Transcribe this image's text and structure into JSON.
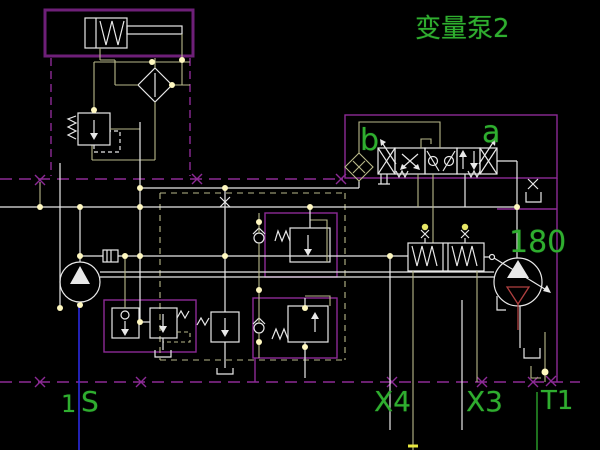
{
  "title": "变量泵2",
  "labels": {
    "pump_title": "变量泵2",
    "valve_solenoid_b": "b",
    "valve_solenoid_a": "a",
    "pump_displacement": "180",
    "port_1": "1",
    "port_s": "S",
    "port_x4": "X4",
    "port_x3": "X3",
    "port_t1": "T1"
  },
  "colors": {
    "background": "#000000",
    "frame_magenta": "#8d2a96",
    "line_white": "#e8e8e8",
    "line_yellow": "#b9b98a",
    "text_green": "#2fae2f",
    "suction_blue": "#2a2ae0",
    "drain_red": "#b04040",
    "node_dot": "#fff8c0"
  },
  "symbols": {
    "top_left": "pilot-piston-symbol",
    "filter": "filter-diamond-symbol",
    "relief": "pressure-relief-valve-symbol",
    "charge_pump": "charge-pump-symbol",
    "main_pump": "variable-main-pump-symbol",
    "servo": "servo-cylinder-symbol",
    "directional_valve": "solenoid-directional-valve-symbol",
    "coupling": "orifice-diamond-symbol",
    "tank": "tank-symbol"
  }
}
